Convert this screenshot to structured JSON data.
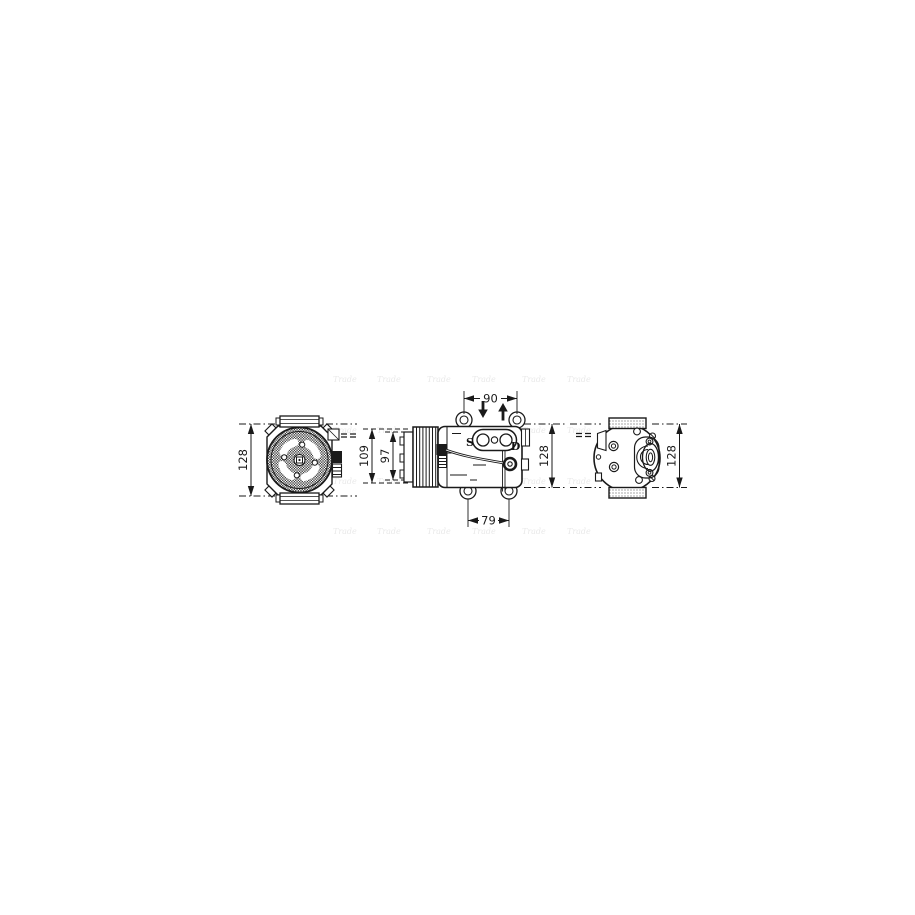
{
  "page": {
    "background_color": "#ffffff"
  },
  "watermark": {
    "text": "Trade",
    "color": "#e9e9e9"
  },
  "diagram": {
    "line_color": "#1a1a1a",
    "front_view": {
      "height_dim": "128"
    },
    "side_view": {
      "overall_dia_dim": "109",
      "pulley_dia_dim": "97",
      "top_width_dim": "90",
      "bottom_width_dim": "79",
      "height_dim": "128",
      "suction_port_label": "S",
      "discharge_port_label": "D"
    },
    "rear_view": {
      "height_dim": "128"
    }
  }
}
